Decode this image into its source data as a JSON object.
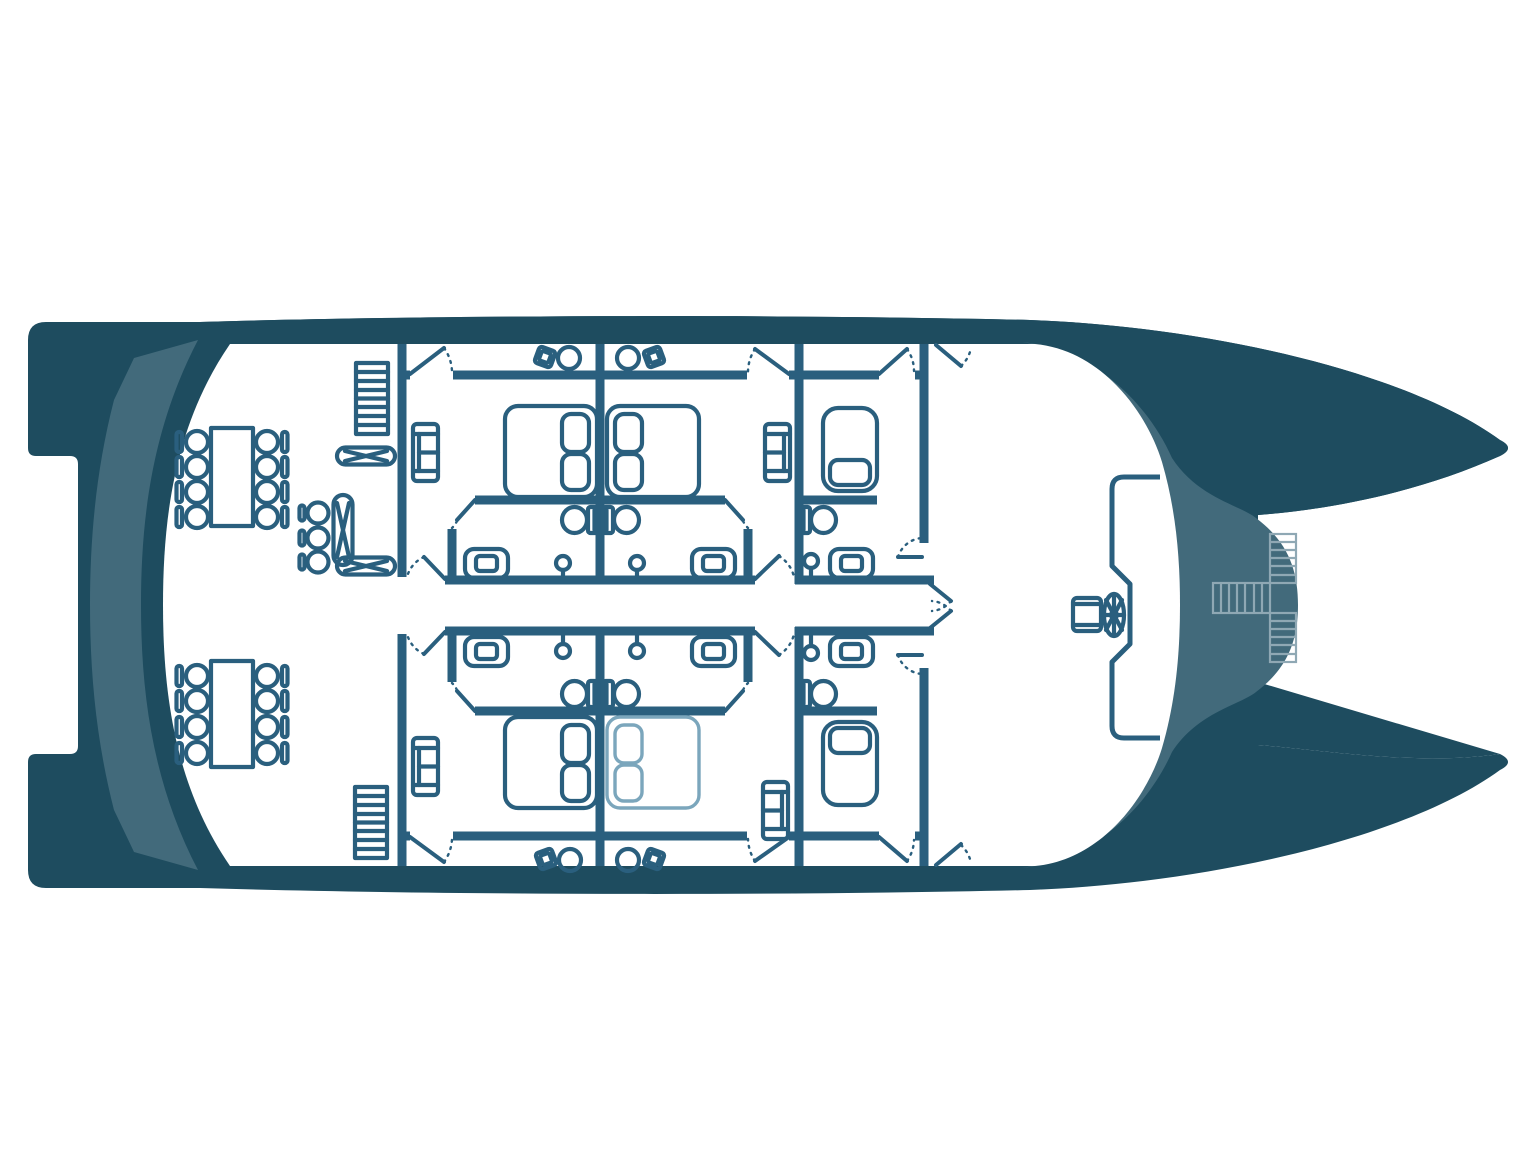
{
  "title": "Catamaran cabin deck floor plan",
  "orientation": "bow to the right, stern (swim platforms) to the left",
  "colors": {
    "bg": "#ffffff",
    "hull-dark": "#1e4c5f",
    "hull-mid": "#426a7b",
    "plan-ink": "#2a5f7e",
    "plan-light": "#7ba6bc",
    "stairs-light": "#8fa8b4"
  },
  "summary": {
    "double_cabins": 4,
    "single_cabins": 2,
    "bathrooms": 6,
    "dining_tables": 2,
    "dining_chairs": 16,
    "folding_tables": 3,
    "stools": 3,
    "interior_staircases": 2,
    "foredeck_staircases": 1,
    "helm_stations": 1
  },
  "rooms": [
    {
      "id": "saloon",
      "label": "Aft saloon and dining area",
      "items": [
        "dining table with 8 chairs (upper)",
        "dining table with 8 chairs (lower)",
        "folding table x3",
        "stool x3",
        "staircase port",
        "staircase starboard"
      ]
    },
    {
      "id": "cabin-port-aft",
      "label": "Double cabin, port aft",
      "items": [
        "double bed with 2 pillows",
        "sofa",
        "toilet",
        "washbasin",
        "shower",
        "door to side deck",
        "door to corridor",
        "bathroom door"
      ]
    },
    {
      "id": "cabin-port-fwd",
      "label": "Double cabin, port forward",
      "items": [
        "double bed with 2 pillows",
        "sofa",
        "toilet",
        "washbasin",
        "shower",
        "door to side deck",
        "door to corridor",
        "bathroom door"
      ]
    },
    {
      "id": "cabin-port-single",
      "label": "Single cabin, port",
      "items": [
        "single bed with pillow",
        "toilet",
        "washbasin",
        "shower",
        "door to side deck",
        "door to cockpit side"
      ]
    },
    {
      "id": "cabin-stbd-aft",
      "label": "Double cabin, starboard aft",
      "items": [
        "double bed with 2 pillows",
        "sofa",
        "toilet",
        "washbasin",
        "shower",
        "door to side deck",
        "door to corridor",
        "bathroom door"
      ]
    },
    {
      "id": "cabin-stbd-fwd",
      "label": "Double cabin, starboard forward (bed drawn in light stroke)",
      "items": [
        "double bed with 2 pillows (light)",
        "sofa",
        "toilet",
        "washbasin",
        "shower",
        "door to side deck",
        "door to corridor",
        "bathroom door"
      ]
    },
    {
      "id": "cabin-stbd-single",
      "label": "Single cabin, starboard",
      "items": [
        "single bed with pillow",
        "toilet",
        "washbasin",
        "shower",
        "door to side deck",
        "door to cockpit side"
      ]
    },
    {
      "id": "corridor",
      "label": "Central corridor",
      "items": [
        "cabin doors",
        "double doors to forward cockpit"
      ]
    },
    {
      "id": "side-decks",
      "label": "Side decks",
      "items": [
        "stool and round table pair x4",
        "deck doors"
      ]
    },
    {
      "id": "cockpit",
      "label": "Forward cockpit / helm",
      "items": [
        "helm seat",
        "steering wheel",
        "console edge"
      ]
    },
    {
      "id": "foredeck",
      "label": "Foredeck bridge between bows",
      "items": [
        "cross-shaped staircase"
      ]
    }
  ]
}
